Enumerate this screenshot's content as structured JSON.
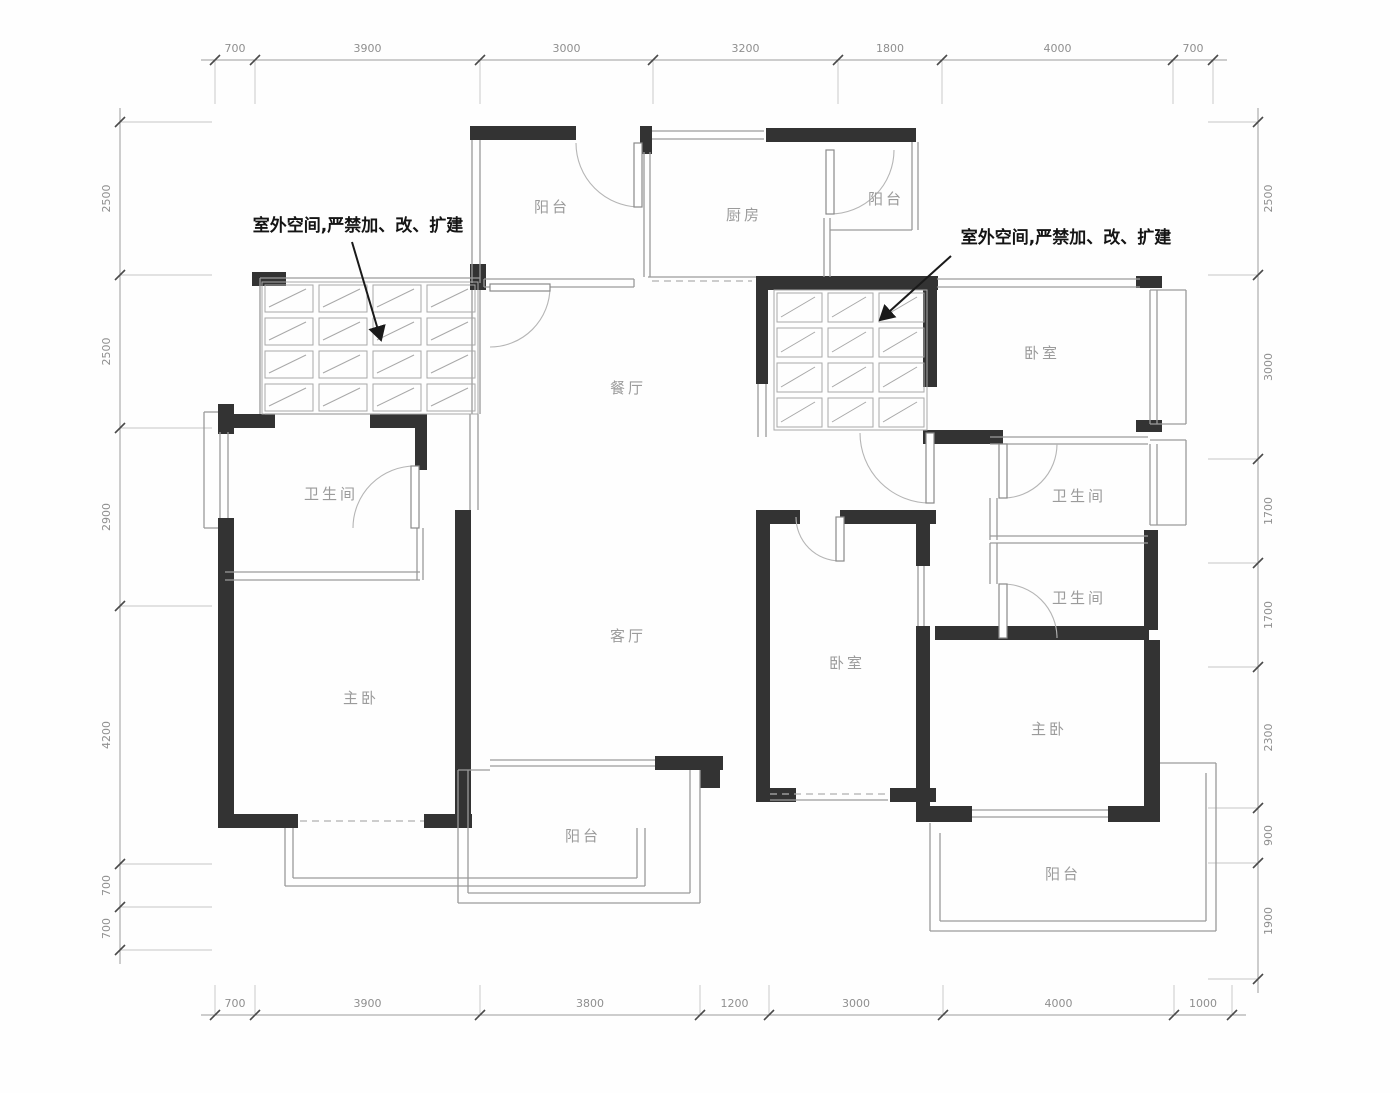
{
  "plan": {
    "type": "residential floor plan",
    "unit": "mm"
  },
  "annotations": {
    "left": "室外空间,严禁加、改、扩建",
    "right": "室外空间,严禁加、改、扩建"
  },
  "rooms": [
    {
      "id": "balcony-top-left",
      "label": "阳台"
    },
    {
      "id": "kitchen",
      "label": "厨房"
    },
    {
      "id": "balcony-top-right",
      "label": "阳台"
    },
    {
      "id": "bedroom-top-right",
      "label": "卧室"
    },
    {
      "id": "dining-room",
      "label": "餐厅"
    },
    {
      "id": "bathroom-left",
      "label": "卫生间"
    },
    {
      "id": "bathroom-right-top",
      "label": "卫生间"
    },
    {
      "id": "bathroom-right-bottom",
      "label": "卫生间"
    },
    {
      "id": "living-room",
      "label": "客厅"
    },
    {
      "id": "bedroom-middle",
      "label": "卧室"
    },
    {
      "id": "master-bedroom-left",
      "label": "主卧"
    },
    {
      "id": "master-bedroom-right",
      "label": "主卧"
    },
    {
      "id": "balcony-bottom-left",
      "label": "阳台"
    },
    {
      "id": "balcony-bottom-right",
      "label": "阳台"
    }
  ],
  "dimensions": {
    "top": [
      "700",
      "3900",
      "3000",
      "3200",
      "1800",
      "4000",
      "700"
    ],
    "bottom": [
      "700",
      "3900",
      "3800",
      "1200",
      "3000",
      "4000",
      "1000"
    ],
    "left": [
      "2500",
      "2500",
      "2900",
      "4200",
      "700",
      "700"
    ],
    "right": [
      "2500",
      "3000",
      "1700",
      "1700",
      "2300",
      "900",
      "1900"
    ]
  }
}
